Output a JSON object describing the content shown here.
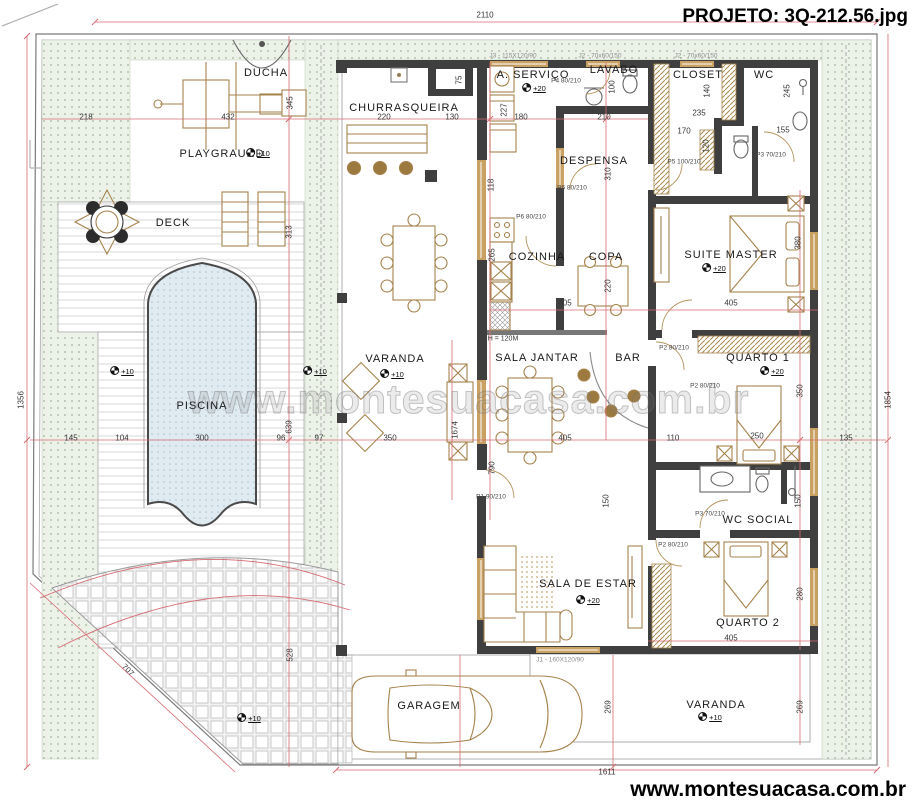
{
  "title": "PROJETO: 3Q-212.56.jpg",
  "watermark": "www.montesuacasa.com.br",
  "footer": "www.montesuacasa.com.br",
  "colors": {
    "wall": "#3f3f3f",
    "dimension_line": "#d66a72",
    "wood": "#a5824c",
    "pool_fill": "#dfeaf1",
    "landscape_fill": "#edf2e9"
  },
  "labels": {
    "rooms": [
      {
        "t": "DUCHA",
        "x": 266,
        "y": 73
      },
      {
        "t": "PLAYGRAUND",
        "x": 222,
        "y": 154
      },
      {
        "t": "DECK",
        "x": 173,
        "y": 223
      },
      {
        "t": "PISCINA",
        "x": 202,
        "y": 406
      },
      {
        "t": "CHURRASQUEIRA",
        "x": 404,
        "y": 108
      },
      {
        "t": "A. SERVIÇO",
        "x": 533,
        "y": 75
      },
      {
        "t": "LAVABO",
        "x": 614,
        "y": 70
      },
      {
        "t": "CLOSET",
        "x": 698,
        "y": 75
      },
      {
        "t": "WC",
        "x": 764,
        "y": 75
      },
      {
        "t": "DESPENSA",
        "x": 594,
        "y": 161
      },
      {
        "t": "COZINHA",
        "x": 537,
        "y": 257
      },
      {
        "t": "COPA",
        "x": 606,
        "y": 257
      },
      {
        "t": "SUITE MASTER",
        "x": 731,
        "y": 255
      },
      {
        "t": "VARANDA",
        "x": 395,
        "y": 359
      },
      {
        "t": "SALA JANTAR",
        "x": 537,
        "y": 358
      },
      {
        "t": "BAR",
        "x": 628,
        "y": 358
      },
      {
        "t": "QUARTO 1",
        "x": 758,
        "y": 358
      },
      {
        "t": "WC SOCIAL",
        "x": 758,
        "y": 520
      },
      {
        "t": "SALA DE ESTAR",
        "x": 588,
        "y": 584
      },
      {
        "t": "QUARTO 2",
        "x": 748,
        "y": 623
      },
      {
        "t": "GARAGEM",
        "x": 429,
        "y": 706
      },
      {
        "t": "VARANDA",
        "x": 716,
        "y": 705
      }
    ],
    "dims": [
      {
        "t": "2110",
        "x": 485,
        "y": 15
      },
      {
        "t": "1611",
        "x": 607,
        "y": 772
      },
      {
        "t": "1356",
        "x": 21,
        "y": 400,
        "r": -90
      },
      {
        "t": "1854",
        "x": 888,
        "y": 400,
        "r": -90
      },
      {
        "t": "218",
        "x": 86,
        "y": 117
      },
      {
        "t": "432",
        "x": 228,
        "y": 117
      },
      {
        "t": "345",
        "x": 290,
        "y": 103,
        "r": -90
      },
      {
        "t": "220",
        "x": 384,
        "y": 117
      },
      {
        "t": "130",
        "x": 452,
        "y": 117
      },
      {
        "t": "75",
        "x": 459,
        "y": 80,
        "r": -90
      },
      {
        "t": "227",
        "x": 504,
        "y": 110,
        "r": -90
      },
      {
        "t": "180",
        "x": 521,
        "y": 117
      },
      {
        "t": "210",
        "x": 604,
        "y": 117
      },
      {
        "t": "100",
        "x": 612,
        "y": 87,
        "r": -90
      },
      {
        "t": "235",
        "x": 699,
        "y": 113
      },
      {
        "t": "140",
        "x": 707,
        "y": 91,
        "r": -90
      },
      {
        "t": "170",
        "x": 684,
        "y": 131
      },
      {
        "t": "120",
        "x": 706,
        "y": 146,
        "r": -90
      },
      {
        "t": "245",
        "x": 787,
        "y": 91,
        "r": -90
      },
      {
        "t": "155",
        "x": 783,
        "y": 130
      },
      {
        "t": "118",
        "x": 491,
        "y": 185,
        "r": -90
      },
      {
        "t": "310",
        "x": 608,
        "y": 174,
        "r": -90
      },
      {
        "t": "265",
        "x": 492,
        "y": 255,
        "r": -90
      },
      {
        "t": "220",
        "x": 608,
        "y": 286,
        "r": -90
      },
      {
        "t": "405",
        "x": 565,
        "y": 303
      },
      {
        "t": "405",
        "x": 731,
        "y": 303
      },
      {
        "t": "380",
        "x": 798,
        "y": 243,
        "r": -90
      },
      {
        "t": "313",
        "x": 289,
        "y": 232,
        "r": -90
      },
      {
        "t": "145",
        "x": 71,
        "y": 438
      },
      {
        "t": "104",
        "x": 122,
        "y": 438
      },
      {
        "t": "300",
        "x": 202,
        "y": 438
      },
      {
        "t": "96",
        "x": 281,
        "y": 438
      },
      {
        "t": "97",
        "x": 319,
        "y": 438
      },
      {
        "t": "350",
        "x": 390,
        "y": 438
      },
      {
        "t": "639",
        "x": 289,
        "y": 427,
        "r": -90
      },
      {
        "t": "1674",
        "x": 455,
        "y": 430,
        "r": -90
      },
      {
        "t": "405",
        "x": 565,
        "y": 438
      },
      {
        "t": "110",
        "x": 673,
        "y": 438
      },
      {
        "t": "250",
        "x": 757,
        "y": 436
      },
      {
        "t": "135",
        "x": 846,
        "y": 438
      },
      {
        "t": "350",
        "x": 800,
        "y": 391,
        "r": -90
      },
      {
        "t": "790",
        "x": 492,
        "y": 468,
        "r": -90
      },
      {
        "t": "150",
        "x": 606,
        "y": 501,
        "r": -90
      },
      {
        "t": "150",
        "x": 798,
        "y": 501,
        "r": -90
      },
      {
        "t": "280",
        "x": 800,
        "y": 594,
        "r": -90
      },
      {
        "t": "405",
        "x": 731,
        "y": 638
      },
      {
        "t": "269",
        "x": 608,
        "y": 707,
        "r": -90
      },
      {
        "t": "269",
        "x": 800,
        "y": 707,
        "r": -90
      },
      {
        "t": "528",
        "x": 290,
        "y": 655,
        "r": -90
      },
      {
        "t": "707",
        "x": 128,
        "y": 670,
        "r": 45
      }
    ],
    "doors": [
      {
        "t": "P4 80/210",
        "x": 566,
        "y": 81
      },
      {
        "t": "P6 80/210",
        "x": 572,
        "y": 188
      },
      {
        "t": "P6 80/210",
        "x": 531,
        "y": 217
      },
      {
        "t": "P5 100/210",
        "x": 684,
        "y": 162
      },
      {
        "t": "P3 70/210",
        "x": 771,
        "y": 155
      },
      {
        "t": "P3 70/210",
        "x": 710,
        "y": 514
      },
      {
        "t": "P2 80/210",
        "x": 674,
        "y": 348
      },
      {
        "t": "P2 80/210",
        "x": 705,
        "y": 386
      },
      {
        "t": "P2 80/210",
        "x": 673,
        "y": 545
      },
      {
        "t": "P1 90/210",
        "x": 491,
        "y": 497
      }
    ],
    "windows": [
      {
        "t": "J3 - 115X120/90",
        "x": 513,
        "y": 56
      },
      {
        "t": "J2 - 70x60/150",
        "x": 600,
        "y": 56
      },
      {
        "t": "J2 - 70x60/150",
        "x": 696,
        "y": 56
      },
      {
        "t": "J1 - 160X120/90",
        "x": 560,
        "y": 660
      }
    ],
    "markers": [
      {
        "t": "+10",
        "x": 258,
        "y": 153
      },
      {
        "t": "+10",
        "x": 122,
        "y": 371
      },
      {
        "t": "+10",
        "x": 315,
        "y": 371
      },
      {
        "t": "+10",
        "x": 392,
        "y": 374
      },
      {
        "t": "+20",
        "x": 534,
        "y": 88
      },
      {
        "t": "+20",
        "x": 714,
        "y": 268
      },
      {
        "t": "+20",
        "x": 772,
        "y": 371
      },
      {
        "t": "+20",
        "x": 588,
        "y": 600
      },
      {
        "t": "+10",
        "x": 710,
        "y": 717
      },
      {
        "t": "+10",
        "x": 249,
        "y": 718
      }
    ],
    "notes": [
      {
        "t": "H = 120M",
        "x": 503,
        "y": 339
      }
    ]
  }
}
